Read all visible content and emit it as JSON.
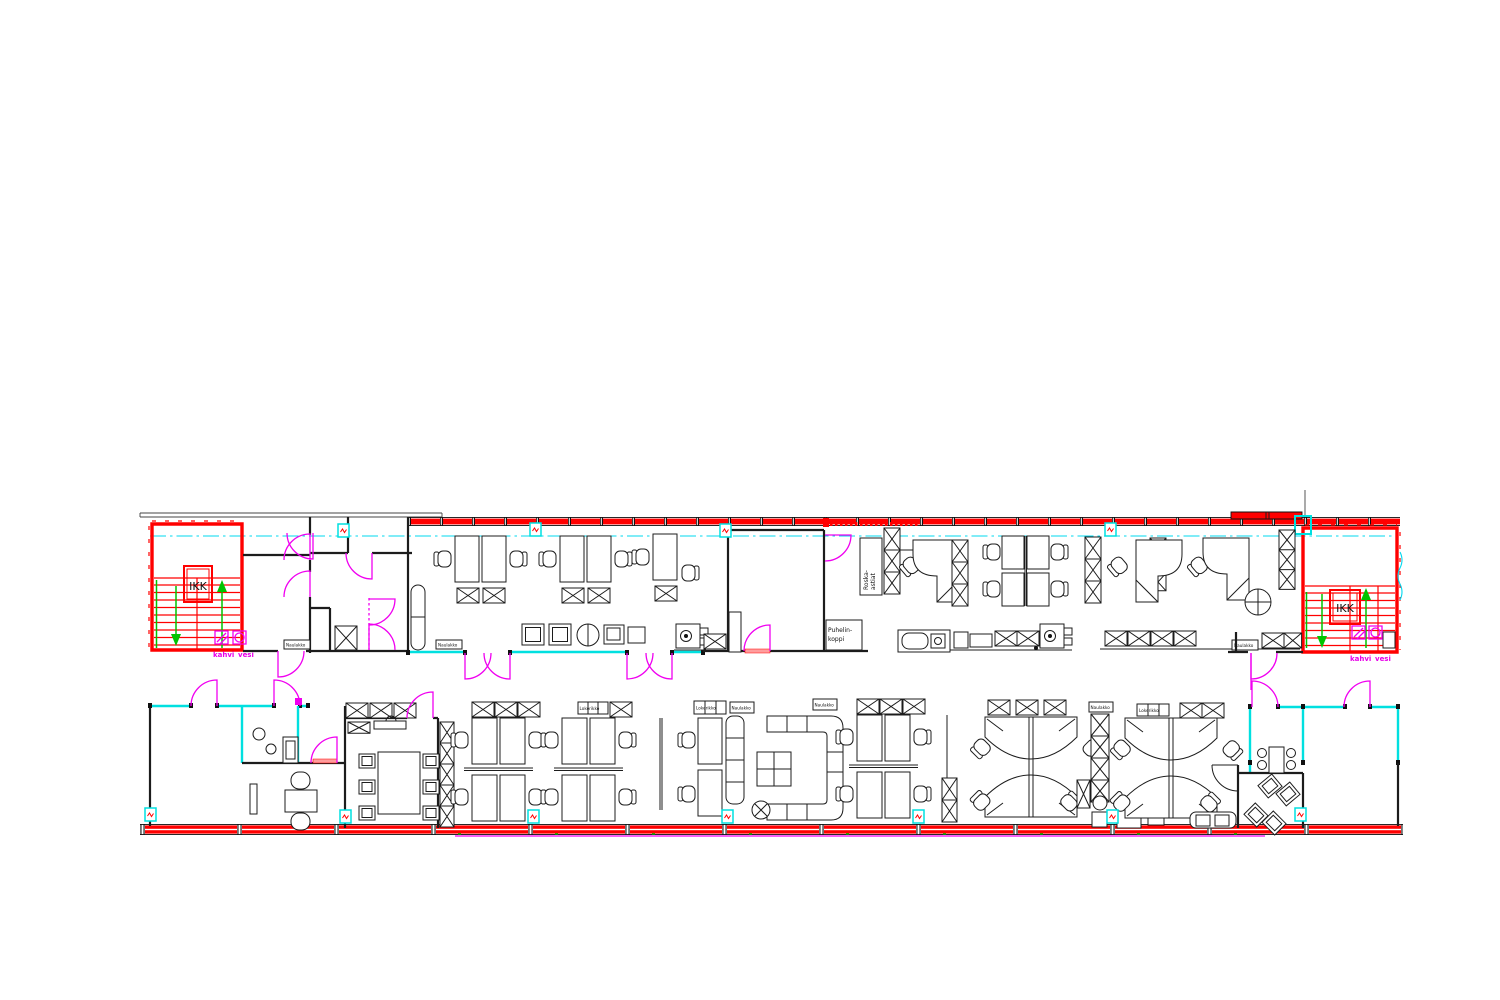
{
  "drawing": {
    "kind": "office-floor-plan-cad",
    "labels": {
      "stairwell": "IKK",
      "coffee": "kahvi",
      "water": "vesi",
      "phone1": "Puhelin-",
      "phone2": "koppi",
      "waste1": "Roska-",
      "waste2": "astiat",
      "locker": "Lokerikko",
      "coatrack": "Naulakko"
    },
    "colors": {
      "exterior_wall": "#ff0000",
      "interior_line": "#1c1c1c",
      "door": "#ff00f0",
      "glass_partition": "#00e0e0",
      "stair_arrow": "#00c400",
      "centerline": "#00e0e0",
      "label_accent": "#e800e8",
      "sill_underline": "#ff00f0"
    },
    "icons": {
      "sprinkler_marker": "sensor-box-icon",
      "door_swing": "door-arc-icon",
      "storage_cross": "x-cabinet-icon"
    }
  }
}
